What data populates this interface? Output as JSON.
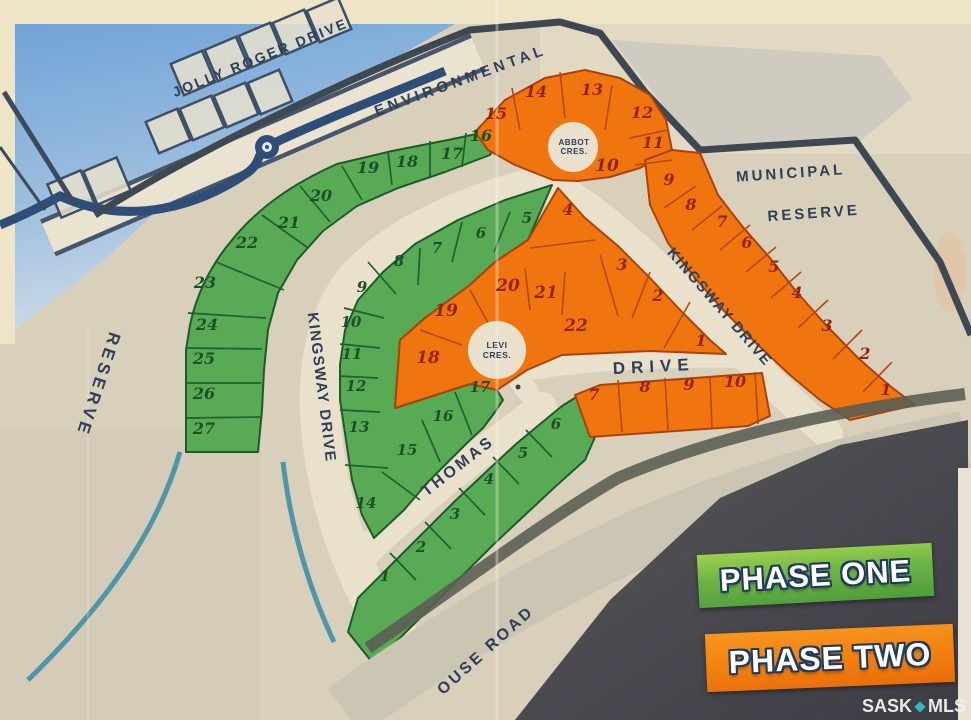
{
  "map": {
    "colors": {
      "paper": "#d9d0bb",
      "road": "#e9e1cc",
      "phase_one_fill": "#58aa54",
      "phase_one_line": "#1e5a2c",
      "phase_one_number": "#1c5128",
      "phase_two_fill": "#f1750f",
      "phase_two_line": "#ab420e",
      "phase_two_number": "#92250a",
      "boundary": "#3d4852",
      "label_ink": "#2e3f58",
      "water_blue": "#6fa3d8"
    },
    "street_labels": [
      {
        "id": "jolly-roger-drive",
        "text": "JOLLY ROGER DRIVE",
        "x": 262,
        "y": 62,
        "rot": -22,
        "size": 14,
        "ls": 2.5
      },
      {
        "id": "environmental",
        "text": "ENVIRONMENTAL",
        "x": 462,
        "y": 85,
        "rot": -20,
        "size": 15,
        "ls": 4
      },
      {
        "id": "municipal",
        "text": "MUNICIPAL",
        "x": 791,
        "y": 178,
        "rot": -4,
        "size": 15,
        "ls": 3
      },
      {
        "id": "municipal-reserve",
        "text": "RESERVE",
        "x": 814,
        "y": 218,
        "rot": -4,
        "size": 15,
        "ls": 3
      },
      {
        "id": "reserve-west",
        "text": "RESERVE",
        "x": 93,
        "y": 383,
        "rot": 108,
        "size": 17,
        "ls": 4
      },
      {
        "id": "kingsway-drive-west",
        "text": "KINGSWAY DRIVE",
        "x": 317,
        "y": 388,
        "rot": 83,
        "size": 15,
        "ls": 1.5
      },
      {
        "id": "kingsway-drive-east",
        "text": "KINGSWAY DRIVE",
        "x": 716,
        "y": 310,
        "rot": 49,
        "size": 15,
        "ls": 1.5
      },
      {
        "id": "drive",
        "text": "DRIVE",
        "x": 654,
        "y": 372,
        "rot": -3,
        "size": 17,
        "ls": 6
      },
      {
        "id": "thomas",
        "text": "THOMAS",
        "x": 461,
        "y": 470,
        "rot": -38,
        "size": 16,
        "ls": 3
      },
      {
        "id": "house-road",
        "text": "OUSE ROAD",
        "x": 489,
        "y": 654,
        "rot": -42,
        "size": 16,
        "ls": 3
      },
      {
        "id": "abbot-cres-line1",
        "text": "ABBOT",
        "x": 574,
        "y": 145,
        "rot": 0,
        "size": 8,
        "ls": 0.5
      },
      {
        "id": "abbot-cres-line2",
        "text": "CRES.",
        "x": 574,
        "y": 154,
        "rot": 0,
        "size": 8,
        "ls": 0.5
      },
      {
        "id": "levi-cres-line1",
        "text": "LEVI",
        "x": 497,
        "y": 348,
        "rot": 0,
        "size": 8.5,
        "ls": 0.5
      },
      {
        "id": "levi-cres-line2",
        "text": "CRES.",
        "x": 497,
        "y": 358,
        "rot": 0,
        "size": 8.5,
        "ls": 0.5
      }
    ],
    "phase_one_lot_numbers": {
      "outer_ring": [
        {
          "n": "16",
          "x": 481,
          "y": 141,
          "s": 16
        },
        {
          "n": "17",
          "x": 452,
          "y": 159,
          "s": 16
        },
        {
          "n": "18",
          "x": 407,
          "y": 167,
          "s": 16
        },
        {
          "n": "19",
          "x": 368,
          "y": 173,
          "s": 16
        },
        {
          "n": "20",
          "x": 321,
          "y": 201,
          "s": 16
        },
        {
          "n": "21",
          "x": 289,
          "y": 228,
          "s": 16
        },
        {
          "n": "22",
          "x": 247,
          "y": 248,
          "s": 16
        },
        {
          "n": "23",
          "x": 205,
          "y": 288,
          "s": 16
        },
        {
          "n": "24",
          "x": 207,
          "y": 330,
          "s": 16
        },
        {
          "n": "25",
          "x": 204,
          "y": 364,
          "s": 16
        },
        {
          "n": "26",
          "x": 204,
          "y": 399,
          "s": 16
        },
        {
          "n": "27",
          "x": 204,
          "y": 434,
          "s": 16
        }
      ],
      "inner_ring": [
        {
          "n": "5",
          "x": 527,
          "y": 223,
          "s": 15
        },
        {
          "n": "6",
          "x": 481,
          "y": 238,
          "s": 15
        },
        {
          "n": "7",
          "x": 437,
          "y": 253,
          "s": 15
        },
        {
          "n": "8",
          "x": 399,
          "y": 266,
          "s": 15
        },
        {
          "n": "9",
          "x": 362,
          "y": 292,
          "s": 15
        },
        {
          "n": "10",
          "x": 351,
          "y": 327,
          "s": 15
        },
        {
          "n": "11",
          "x": 352,
          "y": 359,
          "s": 15
        },
        {
          "n": "12",
          "x": 356,
          "y": 391,
          "s": 15
        },
        {
          "n": "13",
          "x": 359,
          "y": 432,
          "s": 15
        },
        {
          "n": "14",
          "x": 366,
          "y": 508,
          "s": 15
        },
        {
          "n": "15",
          "x": 407,
          "y": 455,
          "s": 15
        },
        {
          "n": "16",
          "x": 443,
          "y": 421,
          "s": 15
        },
        {
          "n": "17",
          "x": 480,
          "y": 392,
          "s": 15
        }
      ],
      "thomas_row": [
        {
          "n": "1",
          "x": 385,
          "y": 581,
          "s": 15
        },
        {
          "n": "2",
          "x": 421,
          "y": 552,
          "s": 15
        },
        {
          "n": "3",
          "x": 455,
          "y": 519,
          "s": 15
        },
        {
          "n": "4",
          "x": 489,
          "y": 484,
          "s": 15
        },
        {
          "n": "5",
          "x": 523,
          "y": 458,
          "s": 15
        },
        {
          "n": "6",
          "x": 556,
          "y": 429,
          "s": 15
        }
      ]
    },
    "phase_two_lot_numbers": {
      "abbot_block": [
        {
          "n": "15",
          "x": 496,
          "y": 119,
          "s": 16
        },
        {
          "n": "14",
          "x": 536,
          "y": 97,
          "s": 16
        },
        {
          "n": "13",
          "x": 592,
          "y": 95,
          "s": 16
        },
        {
          "n": "12",
          "x": 642,
          "y": 118,
          "s": 16
        },
        {
          "n": "11",
          "x": 653,
          "y": 148,
          "s": 16
        },
        {
          "n": "10",
          "x": 607,
          "y": 171,
          "s": 17
        }
      ],
      "east_strip": [
        {
          "n": "9",
          "x": 669,
          "y": 185,
          "s": 16
        },
        {
          "n": "8",
          "x": 691,
          "y": 210,
          "s": 16
        },
        {
          "n": "7",
          "x": 722,
          "y": 227,
          "s": 16
        },
        {
          "n": "6",
          "x": 747,
          "y": 248,
          "s": 16
        },
        {
          "n": "5",
          "x": 774,
          "y": 272,
          "s": 16
        },
        {
          "n": "4",
          "x": 797,
          "y": 298,
          "s": 16
        },
        {
          "n": "3",
          "x": 827,
          "y": 331,
          "s": 16
        },
        {
          "n": "2",
          "x": 865,
          "y": 359,
          "s": 16
        },
        {
          "n": "1",
          "x": 886,
          "y": 395,
          "s": 16
        }
      ],
      "inner_block": [
        {
          "n": "4",
          "x": 568,
          "y": 215,
          "s": 16
        },
        {
          "n": "3",
          "x": 622,
          "y": 270,
          "s": 16
        },
        {
          "n": "2",
          "x": 658,
          "y": 301,
          "s": 16
        },
        {
          "n": "1",
          "x": 701,
          "y": 346,
          "s": 16
        },
        {
          "n": "20",
          "x": 508,
          "y": 291,
          "s": 17
        },
        {
          "n": "21",
          "x": 546,
          "y": 298,
          "s": 17
        },
        {
          "n": "22",
          "x": 576,
          "y": 331,
          "s": 17
        },
        {
          "n": "19",
          "x": 446,
          "y": 316,
          "s": 17
        },
        {
          "n": "18",
          "x": 428,
          "y": 363,
          "s": 17
        }
      ],
      "drive_row": [
        {
          "n": "7",
          "x": 594,
          "y": 400,
          "s": 16
        },
        {
          "n": "8",
          "x": 645,
          "y": 392,
          "s": 16
        },
        {
          "n": "9",
          "x": 689,
          "y": 390,
          "s": 16
        },
        {
          "n": "10",
          "x": 735,
          "y": 387,
          "s": 16
        }
      ]
    }
  },
  "legend": {
    "phase_one_label": "PHASE ONE",
    "phase_two_label": "PHASE TWO"
  },
  "watermark": {
    "prefix": "SASK",
    "suffix": "MLS"
  }
}
